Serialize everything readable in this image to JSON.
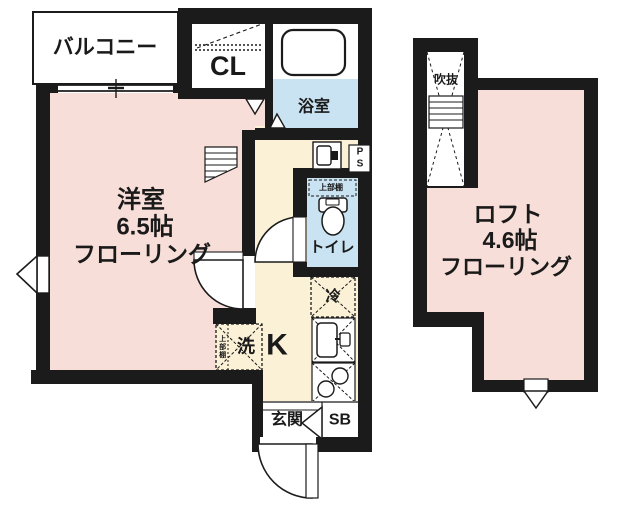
{
  "plan": {
    "type": "japanese-apartment-floorplan",
    "colors": {
      "wall": "#1b1b1b",
      "room_pink": "#f8ded8",
      "kitchen_cream": "#fbf1d7",
      "wet_area_blue": "#cae3f2",
      "background": "#ffffff"
    },
    "floor1": {
      "balcony": "バルコニー",
      "closet": "CL",
      "bath": "浴室",
      "room": {
        "line1": "洋室",
        "line2": "6.5帖",
        "line3": "フローリング"
      },
      "toilet": "トイレ",
      "toilet_shelf": "上部棚",
      "kitchen": "K",
      "fridge": "冷",
      "washer": "洗",
      "washer_shelf": "上部棚",
      "pipe_space": "PS",
      "entrance": "玄関",
      "shoebox": "SB"
    },
    "loft": {
      "void": "吹抜",
      "label": {
        "line1": "ロフト",
        "line2": "4.6帖",
        "line3": "フローリング"
      }
    }
  }
}
